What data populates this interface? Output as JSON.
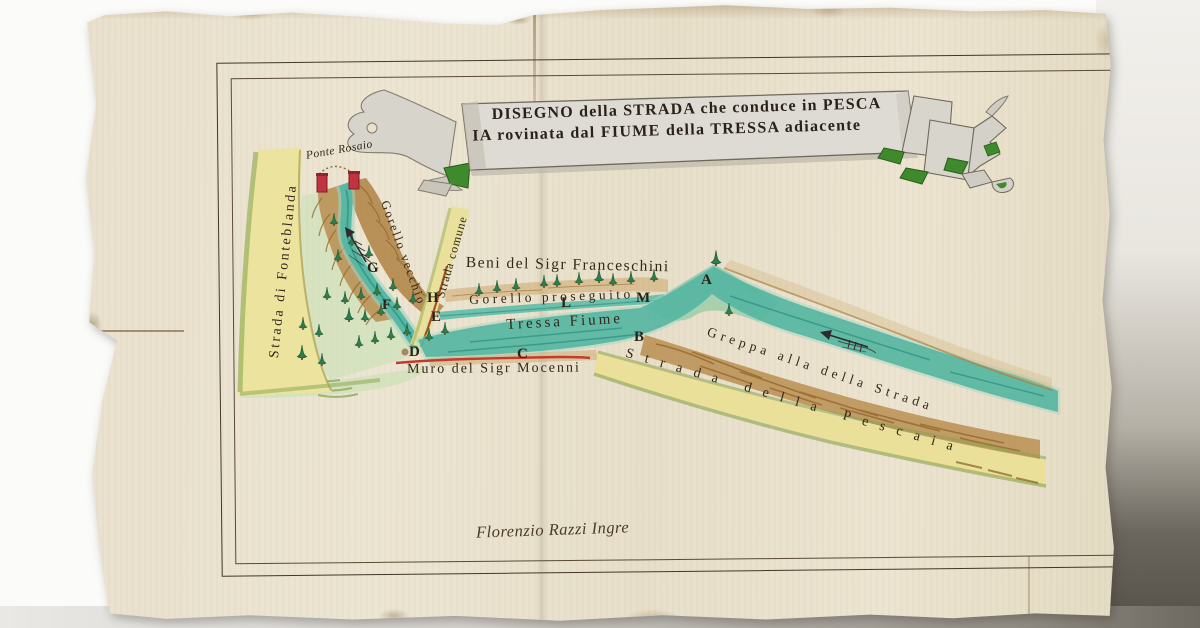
{
  "map": {
    "title": {
      "line1": "DISEGNO della STRADA che conduce in PESCA",
      "line2": "IA rovinata dal FIUME della TRESSA adiacente"
    },
    "labels": {
      "ponte_rosaio": "Ponte Rosaio",
      "strada_fonteblanda": "Strada di Fonteblanda",
      "gorello_vecchio": "Gorello vecchio",
      "strada_comune": "Strada comune",
      "beni_franceschini": "Beni del Sigr Franceschini",
      "gorello_proseguito": "Gorello proseguito",
      "tressa_fiume": "Tressa Fiume",
      "muro_mocenni": "Muro del Sigr Mocenni",
      "greppa": "Greppa alla della Strada",
      "strada_pescaia": "Strada della Pescaia"
    },
    "markers": [
      {
        "letter": "A",
        "x": 701,
        "y": 272
      },
      {
        "letter": "B",
        "x": 634,
        "y": 329
      },
      {
        "letter": "C",
        "x": 517,
        "y": 346
      },
      {
        "letter": "D",
        "x": 409,
        "y": 344
      },
      {
        "letter": "E",
        "x": 431,
        "y": 309
      },
      {
        "letter": "F",
        "x": 382,
        "y": 297
      },
      {
        "letter": "G",
        "x": 367,
        "y": 260
      },
      {
        "letter": "H",
        "x": 427,
        "y": 290
      },
      {
        "letter": "L",
        "x": 561,
        "y": 295
      },
      {
        "letter": "M",
        "x": 636,
        "y": 290
      }
    ],
    "signature": "Florenzio Razzi Ingre",
    "colors": {
      "paper": "#e8e0cc",
      "river": "#56b6a2",
      "road": "#ece29e",
      "slope": "#b3874a",
      "tree": "#2f7d4e",
      "wall_line": "#c23b2e",
      "ink": "#332818",
      "banner_green": "#3e8a2d"
    }
  }
}
